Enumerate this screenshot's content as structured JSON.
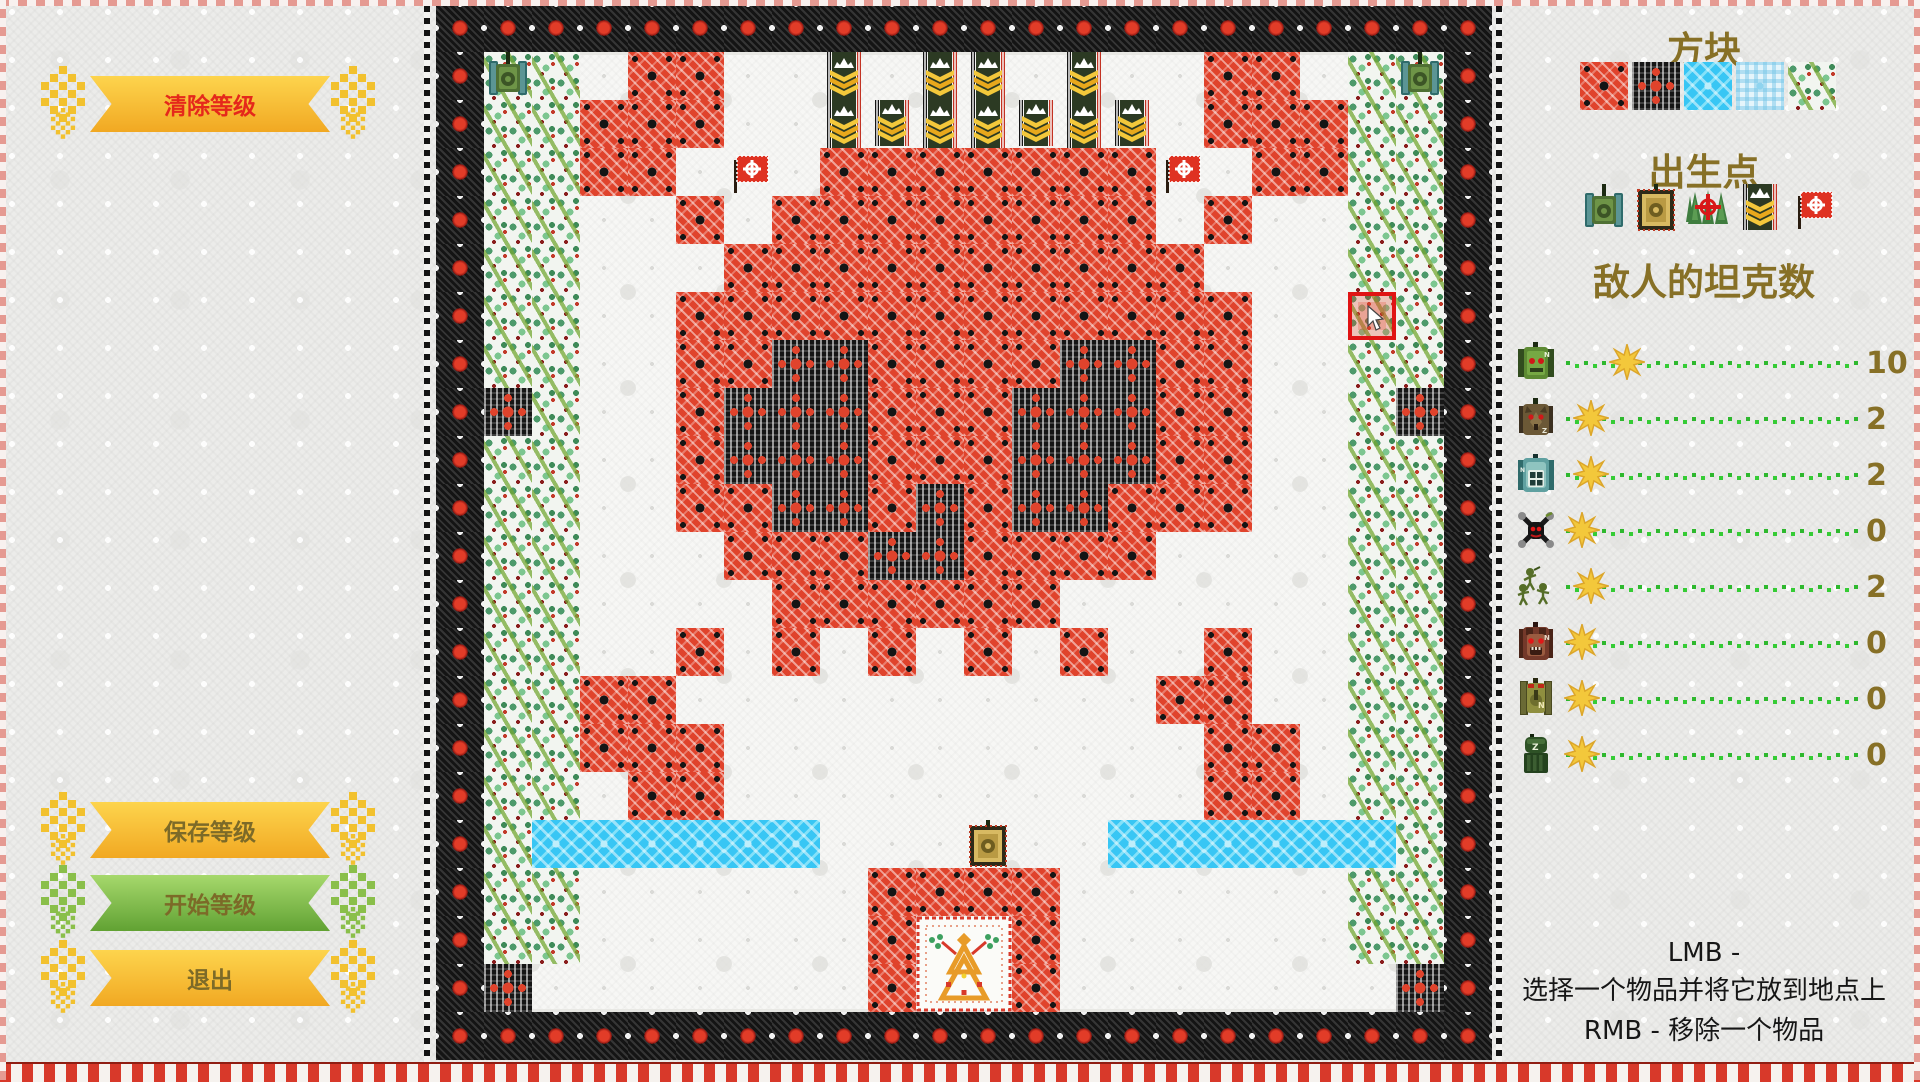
{
  "left_panel": {
    "clear_button": "清除等级",
    "save_button": "保存等级",
    "start_button": "开始等级",
    "exit_button": "退出"
  },
  "right_panel": {
    "blocks_title": "方块",
    "palette": [
      "brick",
      "steel",
      "water",
      "ice",
      "trees"
    ],
    "spawn_title": "出生点",
    "spawn_icons": [
      "player-tank",
      "ally-tank",
      "trees-target",
      "banner",
      "flag"
    ],
    "enemy_title": "敌人的坦克数",
    "enemy_rows": [
      {
        "icon": "green-monster-tank",
        "count": 10
      },
      {
        "icon": "wolf-tank",
        "count": 2
      },
      {
        "icon": "teal-tank",
        "count": 2
      },
      {
        "icon": "spider-drone",
        "count": 0
      },
      {
        "icon": "infantry",
        "count": 2
      },
      {
        "icon": "bear-tank",
        "count": 0
      },
      {
        "icon": "olive-tank",
        "count": 0
      },
      {
        "icon": "pillbox-turret",
        "count": 0
      }
    ],
    "instructions": [
      "LMB -",
      "选择一个物品并将它放到地点上",
      "RMB - 移除一个物品"
    ]
  },
  "map": {
    "grid": [
      "TT.BB..........BB.TT",
      "TTBBB..........BBBTT",
      "TTBB...BBBBBBB..BBTT",
      "TT..B.BBBBBBBB.B..TT",
      "TT...BBBBBBBBBB...TT",
      "TT..BBBBBBBBBBBB..TT",
      "TT..BBSSBBBBSSBB..TT",
      "ST..BSSSBBBSSSBB..TS",
      "TT..BSSSBBBSSSBB..TT",
      "TT..BBSSBSBSSBBB..TT",
      "TT...BBBSSBBBB....TT",
      "TT....BBBBBB......TT",
      "TT..B.B.B.B.B..B..TT",
      "TTBB..........BB..TT",
      "TTBBB..........BB.TT",
      "TT.BB..........BB.TT",
      "TWWWWWW......WWWWWWT",
      "TT......BBBB......TT",
      "TT......B..B......TT",
      "S.......B..B.......S"
    ],
    "legend": {
      ".": "empty",
      "B": "brick",
      "S": "steel",
      "W": "water",
      "T": "trees"
    },
    "sprites": [
      {
        "type": "player-tank",
        "col": 0,
        "row": 0
      },
      {
        "type": "player-tank",
        "col": 19,
        "row": 0
      },
      {
        "type": "banner-tall",
        "col": 7,
        "row": 0
      },
      {
        "type": "banner-tall",
        "col": 9,
        "row": 0
      },
      {
        "type": "banner-tall",
        "col": 10,
        "row": 0
      },
      {
        "type": "banner-tall",
        "col": 12,
        "row": 0
      },
      {
        "type": "banner-short",
        "col": 8,
        "row": 1
      },
      {
        "type": "banner-short",
        "col": 11,
        "row": 1
      },
      {
        "type": "banner-short",
        "col": 13,
        "row": 1
      },
      {
        "type": "flag",
        "col": 5,
        "row": 2
      },
      {
        "type": "flag",
        "col": 14,
        "row": 2
      },
      {
        "type": "ally-tank",
        "col": 10,
        "row": 16
      },
      {
        "type": "emblem",
        "col": 9,
        "row": 18
      },
      {
        "type": "cursor",
        "col": 18,
        "row": 5
      }
    ]
  },
  "colors": {
    "accent_red": "#e0432c",
    "gold": "#f3c83b",
    "olive_text": "#877026",
    "button_yellow": "#f6bc2f",
    "button_green": "#7ab648",
    "track_green": "#2eb82e",
    "water_blue": "#38c6f4",
    "banner_green": "#2c3a23",
    "clear_text_red": "#e5281b"
  }
}
